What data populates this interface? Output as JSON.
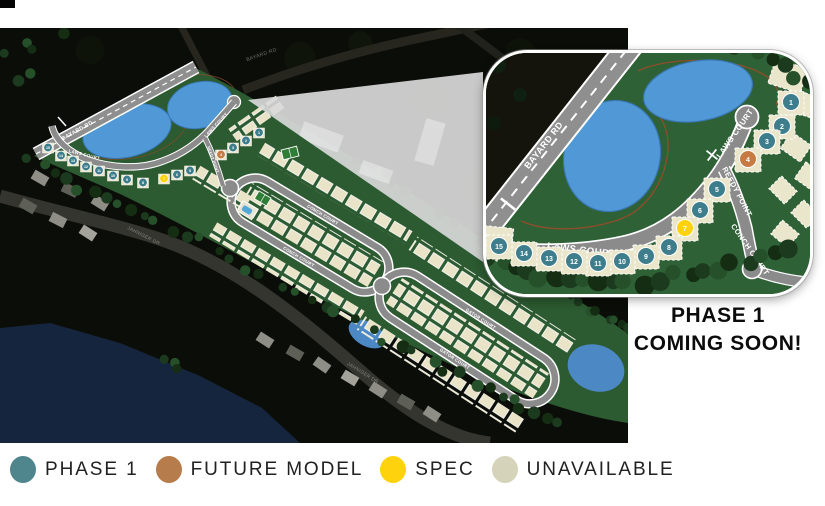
{
  "map": {
    "labels": {
      "bayard_rd": "BAYARD RD",
      "bayard_rd_top": "BAYARD RD",
      "laws_court_w": "LAWS COURT",
      "laws_court_e": "LAWS COURT",
      "reedy_point": "REEDY POINT",
      "conch_court_a": "CONCH COURT",
      "conch_court_b": "CONCH COURT",
      "gator_court_a": "GATOR COURT",
      "gator_court_b": "GATOR COURT",
      "jahniger_dr_a": "JAHNIGER DR",
      "jahniger_dr_b": "JAHNIGER DR"
    }
  },
  "inset": {
    "labels": {
      "bayard_rd": "BAYARD RD",
      "laws_court_lower": "LAWS COURT",
      "laws_court_upper": "LAWS COURT",
      "reedy_point": "REEDY POINT",
      "conch_court": "CONCH COURT"
    }
  },
  "lots": [
    {
      "num": "1",
      "status": "phase1",
      "map": [
        259,
        103
      ],
      "inset": [
        305,
        47
      ]
    },
    {
      "num": "2",
      "status": "phase1",
      "map": [
        246,
        111
      ],
      "inset": [
        296,
        71
      ]
    },
    {
      "num": "3",
      "status": "phase1",
      "map": [
        233,
        118
      ],
      "inset": [
        281,
        86
      ]
    },
    {
      "num": "4",
      "status": "future_model",
      "map": [
        221,
        125
      ],
      "inset": [
        262,
        104
      ]
    },
    {
      "num": "5",
      "status": "phase1",
      "map": [
        190,
        141
      ],
      "inset": [
        231,
        134
      ]
    },
    {
      "num": "6",
      "status": "phase1",
      "map": [
        177,
        145
      ],
      "inset": [
        214,
        155
      ]
    },
    {
      "num": "7",
      "status": "spec",
      "map": [
        164,
        149
      ],
      "inset": [
        199,
        173
      ]
    },
    {
      "num": "8",
      "status": "phase1",
      "map": [
        143,
        153
      ],
      "inset": [
        183,
        192
      ]
    },
    {
      "num": "9",
      "status": "phase1",
      "map": [
        127,
        150
      ],
      "inset": [
        160,
        201
      ]
    },
    {
      "num": "10",
      "status": "phase1",
      "map": [
        113,
        146
      ],
      "inset": [
        136,
        206
      ]
    },
    {
      "num": "11",
      "status": "phase1",
      "map": [
        99,
        141
      ],
      "inset": [
        112,
        208
      ]
    },
    {
      "num": "12",
      "status": "phase1",
      "map": [
        86,
        137
      ],
      "inset": [
        88,
        206
      ]
    },
    {
      "num": "13",
      "status": "phase1",
      "map": [
        73,
        131
      ],
      "inset": [
        63,
        203
      ]
    },
    {
      "num": "14",
      "status": "phase1",
      "map": [
        61,
        126
      ],
      "inset": [
        38,
        198
      ]
    },
    {
      "num": "15",
      "status": "phase1",
      "map": [
        48,
        118
      ],
      "inset": [
        13,
        191
      ]
    }
  ],
  "status_colors": {
    "phase1": "#3E7E8C",
    "future_model": "#C77B43",
    "spec": "#FFD20E",
    "unavailable": "#E9E4C8"
  },
  "callout": {
    "line1": "PHASE 1",
    "line2": "COMING SOON!"
  },
  "legend": [
    {
      "label": "PHASE 1",
      "status": "phase1",
      "color": "#4F858D"
    },
    {
      "label": "FUTURE MODEL",
      "status": "future_model",
      "color": "#B77C4C"
    },
    {
      "label": "SPEC",
      "status": "spec",
      "color": "#FFD20E"
    },
    {
      "label": "UNAVAILABLE",
      "status": "unavailable",
      "color": "#D5D3BA"
    }
  ]
}
